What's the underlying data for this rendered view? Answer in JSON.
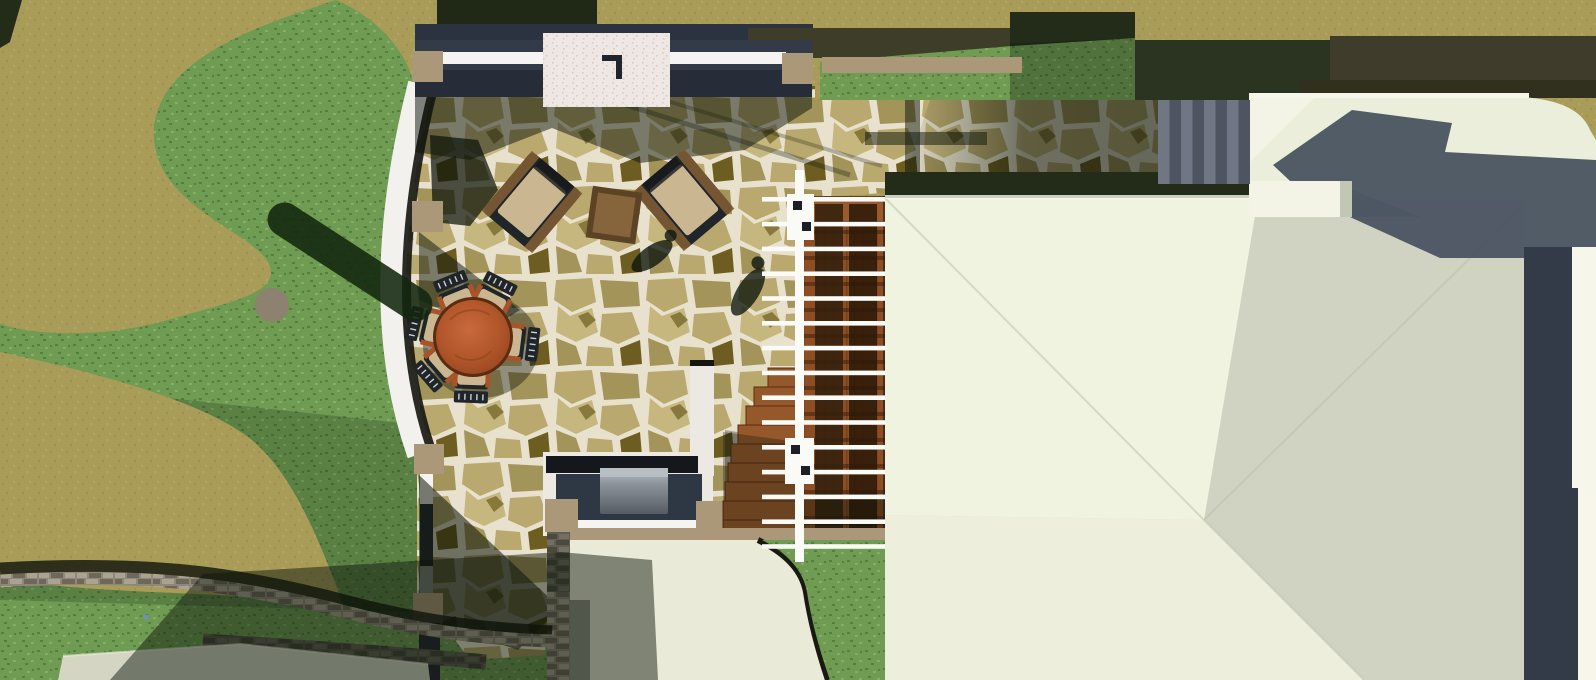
{
  "title": "Overhead 3D rendering of a residential landscape site plan",
  "view": "top-down plan render, no visible text",
  "palette": {
    "olive": "#a89c58",
    "oliveDot": "#9d9150",
    "oliveDot2": "#b2a662",
    "grass": "#6f9b52",
    "grassLight": "#86af66",
    "grassDark": "#54803f",
    "shadow": "#0c140a",
    "hedge": "#222c19",
    "hedge2": "#2a3420",
    "darkBand": "#3e3e28",
    "darkBand2": "#403c2b",
    "hedge3": "#31301e",
    "flagGrout": "#e8e1cd",
    "flagStone1": "#b9a96e",
    "flagStone2": "#a3945a",
    "flagStone3": "#c6b77e",
    "flagDark": "#6d5d20",
    "pathWhite": "#f3f1ed",
    "curb": "#15150f",
    "slate": "#333b48",
    "slateDeep": "#262d38",
    "slateLight": "#4a5361",
    "wallCap": "#f5f4f0",
    "postTan": "#ab9878",
    "fireFace": "#efe7e3",
    "fireDot": "#d8cbc5",
    "woodDeck": "#8e4e23",
    "woodGrain": "#7a3f1b",
    "woodDark": "#33200c",
    "stepWood": "#95582b",
    "stepEdge": "#5a2d10",
    "tableWood": "#b2572b",
    "tableRim": "#5a2c12",
    "chairFrame": "#20252a",
    "cushion": "#cbb692",
    "wicker": "#7d5c33",
    "armSienna": "#a8532a",
    "railWhite": "#fafaf7",
    "roofBright": "#f1f3e1",
    "roofSage": "#d0d3c2",
    "roofSoft": "#edefdc",
    "roofCream": "#ebeedb",
    "roofHip": "#f3f4e5",
    "roofEdge": "#f6f7ea",
    "chimneyShade": "#c2c6b4",
    "concrete1": "#707683",
    "concrete2": "#4e5560",
    "masonry": "#8f8878",
    "masonryLight": "#aaa292",
    "masonryDark": "#6e675a",
    "grill": "#8d939a",
    "grillLight": "#b9bec4",
    "grillDark": "#565c63",
    "terrace": "#e9ead7",
    "slabRoof": "#d4d6c3",
    "flowerBlue": "#6f8fd2",
    "logCap": "#8d8170"
  },
  "scene": {
    "ground": {
      "label": "bare-earth-ground"
    },
    "lawn": {
      "label": "curved-lawn"
    },
    "patio": {
      "label": "flagstone-patio"
    },
    "path": {
      "label": "curved-white-garden-path"
    },
    "fire_feature": {
      "label": "outdoor-fireplace-seat-wall",
      "masonry_posts": 7
    },
    "lounge": {
      "label": "lounge-corner",
      "chairs": 2,
      "side_tables": 1
    },
    "dining": {
      "label": "round-dining-set",
      "chairs": 6
    },
    "kitchen": {
      "label": "outdoor-kitchen-grill"
    },
    "deck": {
      "label": "wood-deck-stairs",
      "fan_steps": 9
    },
    "railing": {
      "label": "white-deck-railing",
      "bars": 15
    },
    "house": {
      "label": "main-house-roof",
      "wings": 2,
      "chimneys": 1
    },
    "hill_steps": {
      "label": "concrete-hill-steps",
      "count": 8
    },
    "retaining_walls": {
      "label": "fieldstone-retaining-walls",
      "segments": 3
    },
    "terrace": {
      "label": "lower-concrete-terrace"
    },
    "guest_roof": {
      "label": "lower-building-roof"
    },
    "log": {
      "label": "fallen-log-on-lawn"
    },
    "people_shadows": {
      "label": "cast-shadows-of-people",
      "count": 2
    }
  }
}
